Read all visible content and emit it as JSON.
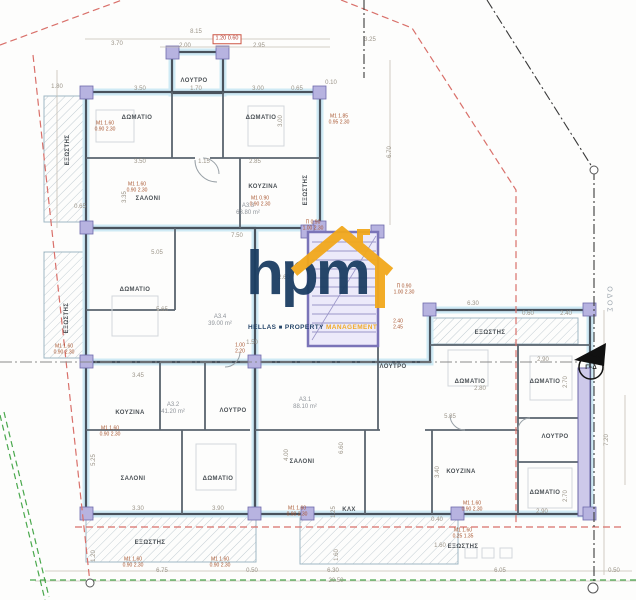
{
  "logo": {
    "text": "hpm",
    "words": [
      "HELLAS",
      "PROPERTY",
      "MANAGEMENT"
    ],
    "navy": "#1c3e63",
    "orange": "#f2a81c"
  },
  "markers": {
    "section": "Γ−Δ",
    "street": "ΟΔΟΣ"
  },
  "colors": {
    "boundary_red": "#d9706a",
    "site_green": "#49a84c",
    "wall_dark": "#49525c",
    "wall_tint": "#cfeaf5",
    "column_lavender": "#b7b3e0",
    "stair_purple": "#7a74b8",
    "dim_text": "#9b9488",
    "room_text": "#4b5156",
    "tag_red": "#a8552f"
  },
  "apartments": [
    {
      "id": "A3.3",
      "area": "63.80 m²",
      "x": 248,
      "y": 210
    },
    {
      "id": "A3.4",
      "area": "39.00 m²",
      "x": 220,
      "y": 321
    },
    {
      "id": "A3.2",
      "area": "41.20 m²",
      "x": 173,
      "y": 409
    },
    {
      "id": "A3.1",
      "area": "88.10 m²",
      "x": 305,
      "y": 404
    }
  ],
  "rooms": [
    {
      "t": "ΛΟΥΤΡΟ",
      "x": 194,
      "y": 81
    },
    {
      "t": "ΔΩΜΑΤΙΟ",
      "x": 137,
      "y": 118
    },
    {
      "t": "ΔΩΜΑΤΙΟ",
      "x": 261,
      "y": 118
    },
    {
      "t": "ΕΞΩΣΤΗΣ",
      "x": 68,
      "y": 150,
      "v": 1
    },
    {
      "t": "ΣΑΛΟΝΙ",
      "x": 148,
      "y": 199
    },
    {
      "t": "ΚΟΥΖΙΝΑ",
      "x": 263,
      "y": 187
    },
    {
      "t": "ΕΞΩΣΤΗΣ",
      "x": 306,
      "y": 190,
      "v": 1
    },
    {
      "t": "ΕΞΩΣΤΗΣ",
      "x": 67,
      "y": 318,
      "v": 1
    },
    {
      "t": "ΔΩΜΑΤΙΟ",
      "x": 135,
      "y": 290
    },
    {
      "t": "ΚΟΥΖΙΝΑ",
      "x": 130,
      "y": 413
    },
    {
      "t": "ΛΟΥΤΡΟ",
      "x": 233,
      "y": 411
    },
    {
      "t": "ΣΑΛΟΝΙ",
      "x": 133,
      "y": 479
    },
    {
      "t": "ΔΩΜΑΤΙΟ",
      "x": 218,
      "y": 479
    },
    {
      "t": "ΕΞΩΣΤΗΣ",
      "x": 150,
      "y": 543
    },
    {
      "t": "ΣΑΛΟΝΙ",
      "x": 302,
      "y": 462
    },
    {
      "t": "ΚΟΥΖΙΝΑ",
      "x": 461,
      "y": 472
    },
    {
      "t": "ΚΛΧ",
      "x": 349,
      "y": 510
    },
    {
      "t": "ΛΟΥΤΡΟ",
      "x": 393,
      "y": 367
    },
    {
      "t": "ΔΩΜΑΤΙΟ",
      "x": 470,
      "y": 382
    },
    {
      "t": "ΔΩΜΑΤΙΟ",
      "x": 545,
      "y": 382
    },
    {
      "t": "ΛΟΥΤΡΟ",
      "x": 555,
      "y": 437
    },
    {
      "t": "ΔΩΜΑΤΙΟ",
      "x": 545,
      "y": 493
    },
    {
      "t": "ΕΞΩΣΤΗΣ",
      "x": 463,
      "y": 547
    },
    {
      "t": "ΕΞΩΣΤΗΣ",
      "x": 490,
      "y": 333
    }
  ],
  "dims": [
    {
      "t": "3.70",
      "x": 117,
      "y": 44
    },
    {
      "t": "8.15",
      "x": 196,
      "y": 32
    },
    {
      "t": "2.00",
      "x": 185,
      "y": 46
    },
    {
      "t": "2.95",
      "x": 259,
      "y": 46
    },
    {
      "t": "1.80",
      "x": 57,
      "y": 87
    },
    {
      "t": "3.50",
      "x": 140,
      "y": 89
    },
    {
      "t": "1.70",
      "x": 196,
      "y": 89
    },
    {
      "t": "3.00",
      "x": 258,
      "y": 89
    },
    {
      "t": "0.65",
      "x": 297,
      "y": 89
    },
    {
      "t": "3.00",
      "x": 281,
      "y": 121,
      "v": 1
    },
    {
      "t": "3.50",
      "x": 140,
      "y": 162
    },
    {
      "t": "1.15",
      "x": 204,
      "y": 162
    },
    {
      "t": "2.85",
      "x": 255,
      "y": 162
    },
    {
      "t": "3.35",
      "x": 125,
      "y": 197,
      "v": 1
    },
    {
      "t": "0.65",
      "x": 80,
      "y": 207
    },
    {
      "t": "7.50",
      "x": 237,
      "y": 236
    },
    {
      "t": "5.05",
      "x": 157,
      "y": 253
    },
    {
      "t": "2.60",
      "x": 284,
      "y": 278
    },
    {
      "t": "5.65",
      "x": 162,
      "y": 310
    },
    {
      "t": "3.45",
      "x": 138,
      "y": 376
    },
    {
      "t": "1.50",
      "x": 252,
      "y": 343
    },
    {
      "t": "5.25",
      "x": 94,
      "y": 460,
      "v": 1
    },
    {
      "t": "4.00",
      "x": 287,
      "y": 455,
      "v": 1
    },
    {
      "t": "3.30",
      "x": 138,
      "y": 509
    },
    {
      "t": "3.90",
      "x": 218,
      "y": 509
    },
    {
      "t": "1.20",
      "x": 94,
      "y": 556,
      "v": 1
    },
    {
      "t": "6.75",
      "x": 162,
      "y": 571
    },
    {
      "t": "0.50",
      "x": 252,
      "y": 571
    },
    {
      "t": "6.30",
      "x": 333,
      "y": 571
    },
    {
      "t": "6.05",
      "x": 500,
      "y": 571
    },
    {
      "t": "0.50",
      "x": 614,
      "y": 571
    },
    {
      "t": "20.50",
      "x": 336,
      "y": 581
    },
    {
      "t": "6.70",
      "x": 390,
      "y": 152,
      "v": 1
    },
    {
      "t": "3.25",
      "x": 370,
      "y": 40
    },
    {
      "t": "0.10",
      "x": 331,
      "y": 83
    },
    {
      "t": "6.30",
      "x": 473,
      "y": 304
    },
    {
      "t": "0.60",
      "x": 528,
      "y": 314
    },
    {
      "t": "2.40",
      "x": 566,
      "y": 314
    },
    {
      "t": "2.90",
      "x": 543,
      "y": 360
    },
    {
      "t": "2.80",
      "x": 480,
      "y": 389
    },
    {
      "t": "5.85",
      "x": 450,
      "y": 417
    },
    {
      "t": "2.70",
      "x": 566,
      "y": 382,
      "v": 1
    },
    {
      "t": "2.70",
      "x": 566,
      "y": 496,
      "v": 1
    },
    {
      "t": "2.90",
      "x": 542,
      "y": 512
    },
    {
      "t": "3.40",
      "x": 438,
      "y": 472,
      "v": 1
    },
    {
      "t": "6.60",
      "x": 342,
      "y": 448,
      "v": 1
    },
    {
      "t": "1.25",
      "x": 334,
      "y": 512,
      "v": 1
    },
    {
      "t": "1.60",
      "x": 337,
      "y": 555,
      "v": 1
    },
    {
      "t": "0.40",
      "x": 437,
      "y": 520
    },
    {
      "t": "1.60",
      "x": 440,
      "y": 546
    },
    {
      "t": "7.20",
      "x": 607,
      "y": 440,
      "v": 1
    }
  ],
  "tags": [
    {
      "a": "Μ1  1.60",
      "b": "0.90 2.30",
      "x": 105,
      "y": 127
    },
    {
      "a": "Μ1  1.60",
      "b": "0.90 2.30",
      "x": 137,
      "y": 188
    },
    {
      "a": "Μ1  0.90",
      "b": "0.90 2.30",
      "x": 260,
      "y": 202
    },
    {
      "a": "Μ1  1.85",
      "b": "0.95 2.30",
      "x": 339,
      "y": 120
    },
    {
      "a": "Π  0.90",
      "b": "1.00 2.30",
      "x": 313,
      "y": 226
    },
    {
      "a": "Π  0.90",
      "b": "1.00 2.30",
      "x": 404,
      "y": 290
    },
    {
      "a": "1.00",
      "b": "2.20",
      "x": 240,
      "y": 349
    },
    {
      "a": "Μ1  1.60",
      "b": "0.90 2.30",
      "x": 64,
      "y": 350
    },
    {
      "a": "Μ1  1.60",
      "b": "0.90 2.30",
      "x": 110,
      "y": 432
    },
    {
      "a": "2.40",
      "b": "2.45",
      "x": 398,
      "y": 325
    },
    {
      "a": "Μ1  1.60",
      "b": "0.90 2.30",
      "x": 133,
      "y": 563
    },
    {
      "a": "Μ1  1.60",
      "b": "0.90 2.30",
      "x": 220,
      "y": 563
    },
    {
      "a": "Μ1  1.60",
      "b": "0.90 2.30",
      "x": 297,
      "y": 512
    },
    {
      "a": "Μ1  1.60",
      "b": "0.90 2.30",
      "x": 472,
      "y": 507
    },
    {
      "a": "Μ1  1.60",
      "b": "0.25 1.35",
      "x": 463,
      "y": 534
    },
    {
      "a": "1.20 0.60",
      "b": "",
      "x": 227,
      "y": 39,
      "boxed": 1
    }
  ]
}
